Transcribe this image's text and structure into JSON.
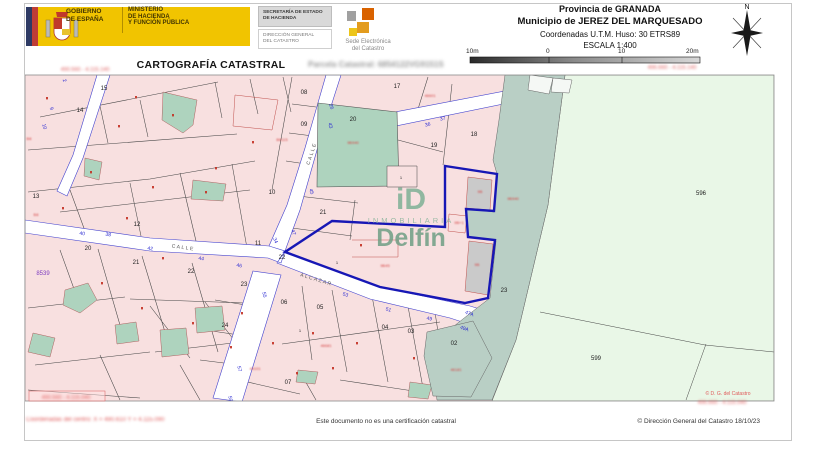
{
  "colors": {
    "gov_yellow": "#f1c400",
    "selected_parcel_blue": "#1717b5",
    "parcel_pink": "#f8e0e0",
    "teal_parcel": "#aed3be",
    "mint_area": "#e9f7e7",
    "sage_area": "#b9cfc5",
    "street_number_blue": "#2a2ad2",
    "redaction_red": "#d64545"
  },
  "header": {
    "gobierno_lines": [
      "GOBIERNO",
      "DE ESPAÑA"
    ],
    "ministerio_lines": [
      "MINISTERIO",
      "DE HACIENDA",
      "Y FUNCIÓN PÚBLICA"
    ],
    "secretaria_lines": [
      "SECRETARÍA DE ESTADO",
      "DE HACIENDA"
    ],
    "direccion_lines": [
      "DIRECCIÓN GENERAL",
      "DEL CATASTRO"
    ],
    "sede_lines": [
      "Sede Electrónica",
      "del Catastro"
    ],
    "provincia": "Provincia de GRANADA",
    "municipio": "Municipio de JEREZ DEL MARQUESADO",
    "coordenadas": "Coordenadas U.T.M. Huso: 30 ETRS89",
    "escala": "ESCALA 1:400",
    "scalebar_labels": [
      "10m",
      "0",
      "10",
      "20m"
    ],
    "north_label": "N"
  },
  "titlebar": {
    "title": "CARTOGRAFÍA CATASTRAL",
    "parcela_redacted": "Parcela Catastral: 6854122VG9151S"
  },
  "watermark": {
    "logo": "iD",
    "line1": "INMOBILIARIA",
    "line2": "Delfín"
  },
  "map": {
    "street_names": [
      {
        "t": "CALLE",
        "x": 313,
        "y": 154,
        "r": -72
      },
      {
        "t": "CALLE",
        "x": 183,
        "y": 249,
        "r": 8
      },
      {
        "t": "ALCAZAR",
        "x": 316,
        "y": 281,
        "r": 17
      }
    ],
    "parcel_numbers": [
      {
        "t": "15",
        "x": 104,
        "y": 90
      },
      {
        "t": "14",
        "x": 80,
        "y": 112
      },
      {
        "t": "13",
        "x": 36,
        "y": 198
      },
      {
        "t": "12",
        "x": 137,
        "y": 226
      },
      {
        "t": "11",
        "x": 258,
        "y": 245
      },
      {
        "t": "10",
        "x": 272,
        "y": 194
      },
      {
        "t": "08",
        "x": 304,
        "y": 94
      },
      {
        "t": "09",
        "x": 304,
        "y": 126
      },
      {
        "t": "17",
        "x": 397,
        "y": 88
      },
      {
        "t": "18",
        "x": 474,
        "y": 136
      },
      {
        "t": "19",
        "x": 434,
        "y": 147
      },
      {
        "t": "20",
        "x": 353,
        "y": 121
      },
      {
        "t": "21",
        "x": 323,
        "y": 214
      },
      {
        "t": "20",
        "x": 88,
        "y": 250
      },
      {
        "t": "21",
        "x": 136,
        "y": 264
      },
      {
        "t": "22",
        "x": 191,
        "y": 273
      },
      {
        "t": "22",
        "x": 282,
        "y": 259
      },
      {
        "t": "23",
        "x": 244,
        "y": 286
      },
      {
        "t": "24",
        "x": 225,
        "y": 327
      },
      {
        "t": "23",
        "x": 504,
        "y": 292
      },
      {
        "t": "06",
        "x": 284,
        "y": 304
      },
      {
        "t": "05",
        "x": 320,
        "y": 309
      },
      {
        "t": "04",
        "x": 385,
        "y": 329
      },
      {
        "t": "03",
        "x": 411,
        "y": 333
      },
      {
        "t": "02",
        "x": 454,
        "y": 345
      },
      {
        "t": "07",
        "x": 288,
        "y": 384
      },
      {
        "t": "596",
        "x": 701,
        "y": 195
      },
      {
        "t": "599",
        "x": 596,
        "y": 360
      },
      {
        "t": "1",
        "x": 401,
        "y": 179,
        "s": 4
      },
      {
        "t": "1",
        "x": 337,
        "y": 264,
        "s": 4
      },
      {
        "t": "1",
        "x": 300,
        "y": 332,
        "s": 4
      }
    ],
    "street_numbers": [
      {
        "t": "2",
        "x": 63,
        "y": 81,
        "r": 72
      },
      {
        "t": "9",
        "x": 50,
        "y": 109,
        "r": 72
      },
      {
        "t": "10",
        "x": 43,
        "y": 127,
        "r": 72
      },
      {
        "t": "26",
        "x": 330,
        "y": 107,
        "r": 72
      },
      {
        "t": "43",
        "x": 329,
        "y": 126,
        "r": 72
      },
      {
        "t": "45",
        "x": 310,
        "y": 192,
        "r": 72
      },
      {
        "t": "47",
        "x": 292,
        "y": 233,
        "r": 68
      },
      {
        "t": "34",
        "x": 274,
        "y": 241,
        "r": 68
      },
      {
        "t": "40",
        "x": 82,
        "y": 235,
        "r": 8
      },
      {
        "t": "38",
        "x": 108,
        "y": 236,
        "r": 8
      },
      {
        "t": "42",
        "x": 150,
        "y": 250,
        "r": 8
      },
      {
        "t": "44",
        "x": 201,
        "y": 260,
        "r": 8
      },
      {
        "t": "46",
        "x": 239,
        "y": 267,
        "r": 10
      },
      {
        "t": "36",
        "x": 428,
        "y": 126,
        "r": -12
      },
      {
        "t": "37",
        "x": 443,
        "y": 120,
        "r": -12
      },
      {
        "t": "53",
        "x": 345,
        "y": 296,
        "r": 18
      },
      {
        "t": "51",
        "x": 388,
        "y": 311,
        "r": 18
      },
      {
        "t": "49",
        "x": 429,
        "y": 320,
        "r": 14
      },
      {
        "t": "47A",
        "x": 469,
        "y": 315,
        "r": 18
      },
      {
        "t": "49A",
        "x": 464,
        "y": 330,
        "r": 18
      },
      {
        "t": "55",
        "x": 263,
        "y": 295,
        "r": 78
      },
      {
        "t": "57",
        "x": 238,
        "y": 369,
        "r": 78
      },
      {
        "t": "59",
        "x": 229,
        "y": 399,
        "r": 78
      }
    ],
    "other_labels": [
      {
        "t": "8539",
        "x": 43,
        "y": 275,
        "c": "#8040c0",
        "s": 6
      },
      {
        "t": "© D. G. del Catastro",
        "x": 728,
        "y": 395,
        "c": "#e05a5a",
        "s": 5
      }
    ],
    "map_redactions": [
      {
        "t": "B6115",
        "x": 282,
        "y": 141
      },
      {
        "t": "9B940",
        "x": 353,
        "y": 144
      },
      {
        "t": "46601",
        "x": 430,
        "y": 97
      },
      {
        "t": "9B940",
        "x": 513,
        "y": 200
      },
      {
        "t": "9B45",
        "x": 385,
        "y": 267
      },
      {
        "t": "9B",
        "x": 480,
        "y": 193
      },
      {
        "t": "9B+1",
        "x": 459,
        "y": 224
      },
      {
        "t": "9B",
        "x": 477,
        "y": 266
      },
      {
        "t": "49101",
        "x": 255,
        "y": 370
      },
      {
        "t": "46181",
        "x": 456,
        "y": 371
      },
      {
        "t": "46681",
        "x": 326,
        "y": 347
      },
      {
        "t": "B8",
        "x": 36,
        "y": 216
      },
      {
        "t": "B8",
        "x": 29,
        "y": 140
      }
    ],
    "corner_redactions": [
      {
        "t": "490.560 - 4.115.140",
        "x": 85,
        "y": 71
      },
      {
        "t": "496.660 - 4.115.140",
        "x": 672,
        "y": 69
      },
      {
        "t": "490.560 - 4.115.040",
        "x": 66,
        "y": 399,
        "box": [
          29,
          391,
          76,
          10
        ]
      },
      {
        "t": "496.660 - 4.115.040",
        "x": 722,
        "y": 404
      }
    ],
    "tiny_marks": [
      [
        135,
        96
      ],
      [
        118,
        125
      ],
      [
        90,
        171
      ],
      [
        152,
        186
      ],
      [
        215,
        167
      ],
      [
        252,
        141
      ],
      [
        62,
        207
      ],
      [
        46,
        97
      ],
      [
        126,
        217
      ],
      [
        162,
        257
      ],
      [
        101,
        282
      ],
      [
        141,
        307
      ],
      [
        192,
        322
      ],
      [
        241,
        312
      ],
      [
        312,
        332
      ],
      [
        356,
        342
      ],
      [
        413,
        357
      ],
      [
        332,
        367
      ],
      [
        272,
        342
      ],
      [
        360,
        244
      ],
      [
        172,
        114
      ],
      [
        205,
        191
      ],
      [
        296,
        372
      ],
      [
        230,
        346
      ]
    ]
  },
  "footer": {
    "disclaimer": "Este documento no es una certificación catastral",
    "copyright": "© Dirección General del Catastro 18/10/23",
    "center_coords_redacted": "Coordenadas del centro: X = 490.610  Y = 4.115.090"
  }
}
